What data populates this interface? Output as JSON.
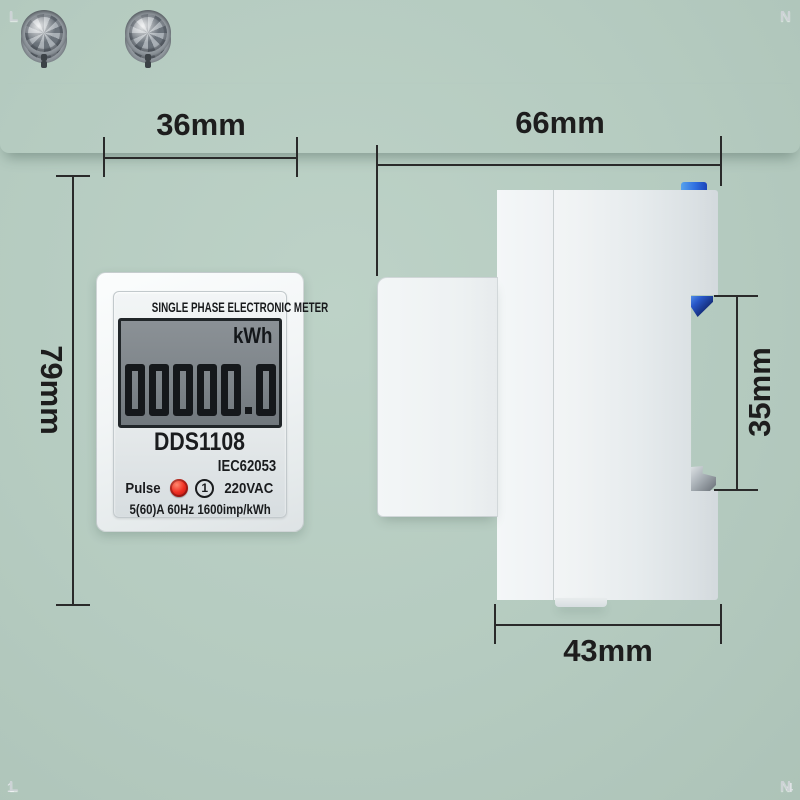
{
  "product": {
    "front": {
      "top_terminal": {
        "left_label": "L",
        "right_label": "N",
        "left_pin": "1",
        "right_pin": "4"
      },
      "bottom_terminal": {
        "left_label": "L",
        "right_label": "N"
      },
      "faceplate": {
        "title": "SINGLE PHASE ELECTRONIC METER",
        "lcd": {
          "unit": "kWh",
          "reading": "00000.0"
        },
        "model": "DDS1108",
        "standard": "IEC62053",
        "pulse_label": "Pulse",
        "phase_mark": "1",
        "voltage": "220VAC",
        "rating": "5(60)A 60Hz 1600imp/kWh"
      }
    },
    "dimensions": {
      "front_width": "36mm",
      "front_height": "79mm",
      "side_depth": "66mm",
      "din_clip_height": "35mm",
      "rear_body_depth": "43mm"
    },
    "colors": {
      "background": "#b5cbc0",
      "housing_white": "#f3f6f7",
      "lcd_panel_gray": "#7e858a",
      "lcd_ink": "#15181b",
      "pulse_led_red": "#e82020",
      "din_clip_blue": "#1d4fd8",
      "dimension_line": "#2a2a2a"
    }
  }
}
